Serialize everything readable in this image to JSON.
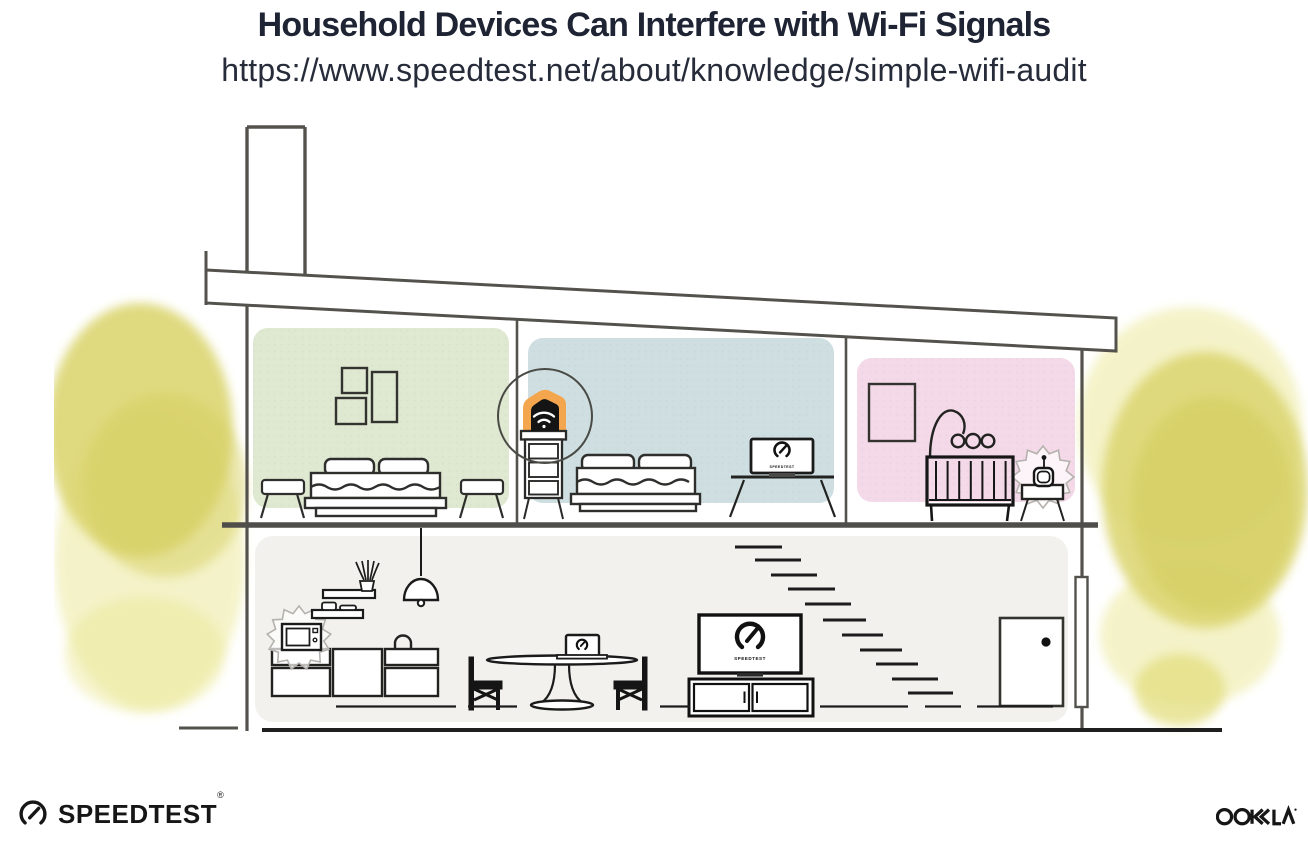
{
  "header": {
    "title": "Household Devices Can Interfere with Wi-Fi Signals",
    "url": "https://www.speedtest.net/about/knowledge/simple-wifi-audit"
  },
  "branding": {
    "speedtest_wordmark": "SPEEDTEST",
    "registered_mark": "®",
    "ookla_wordmark": "OOKLA"
  },
  "screens": {
    "tv_label": "SPEEDTEST",
    "bedroom_laptop_label": "SPEEDTEST"
  },
  "colors": {
    "title_text": "#1e2433",
    "outline_gray": "#54524d",
    "ink_black": "#1b1b1b",
    "bedroom_green": "#dfe8d1",
    "bedroom_blue": "#cfdfe1",
    "nursery_pink": "#f4d9e9",
    "ground_floor_gray": "#f2f1ee",
    "router_orange": "#f3a64d",
    "foliage_yellow": "#dcd672"
  },
  "scene": {
    "rooms": [
      {
        "name": "green-bedroom",
        "items": [
          "wall-frames",
          "double-bed",
          "side-stools"
        ]
      },
      {
        "name": "blue-bedroom",
        "items": [
          "wifi-router-on-dresser",
          "double-bed",
          "laptop-on-desk"
        ]
      },
      {
        "name": "pink-nursery",
        "items": [
          "wall-frame",
          "mobile-arm",
          "crib",
          "baby-monitor-on-table"
        ]
      },
      {
        "name": "ground-floor",
        "items": [
          "kitchen-cabinets",
          "microwave",
          "wall-shelves",
          "pendant-lamp",
          "dining-table-with-laptop",
          "two-chairs",
          "tv-on-console",
          "stairs",
          "front-door"
        ]
      }
    ],
    "interference_sources": [
      "microwave",
      "baby-monitor"
    ]
  }
}
